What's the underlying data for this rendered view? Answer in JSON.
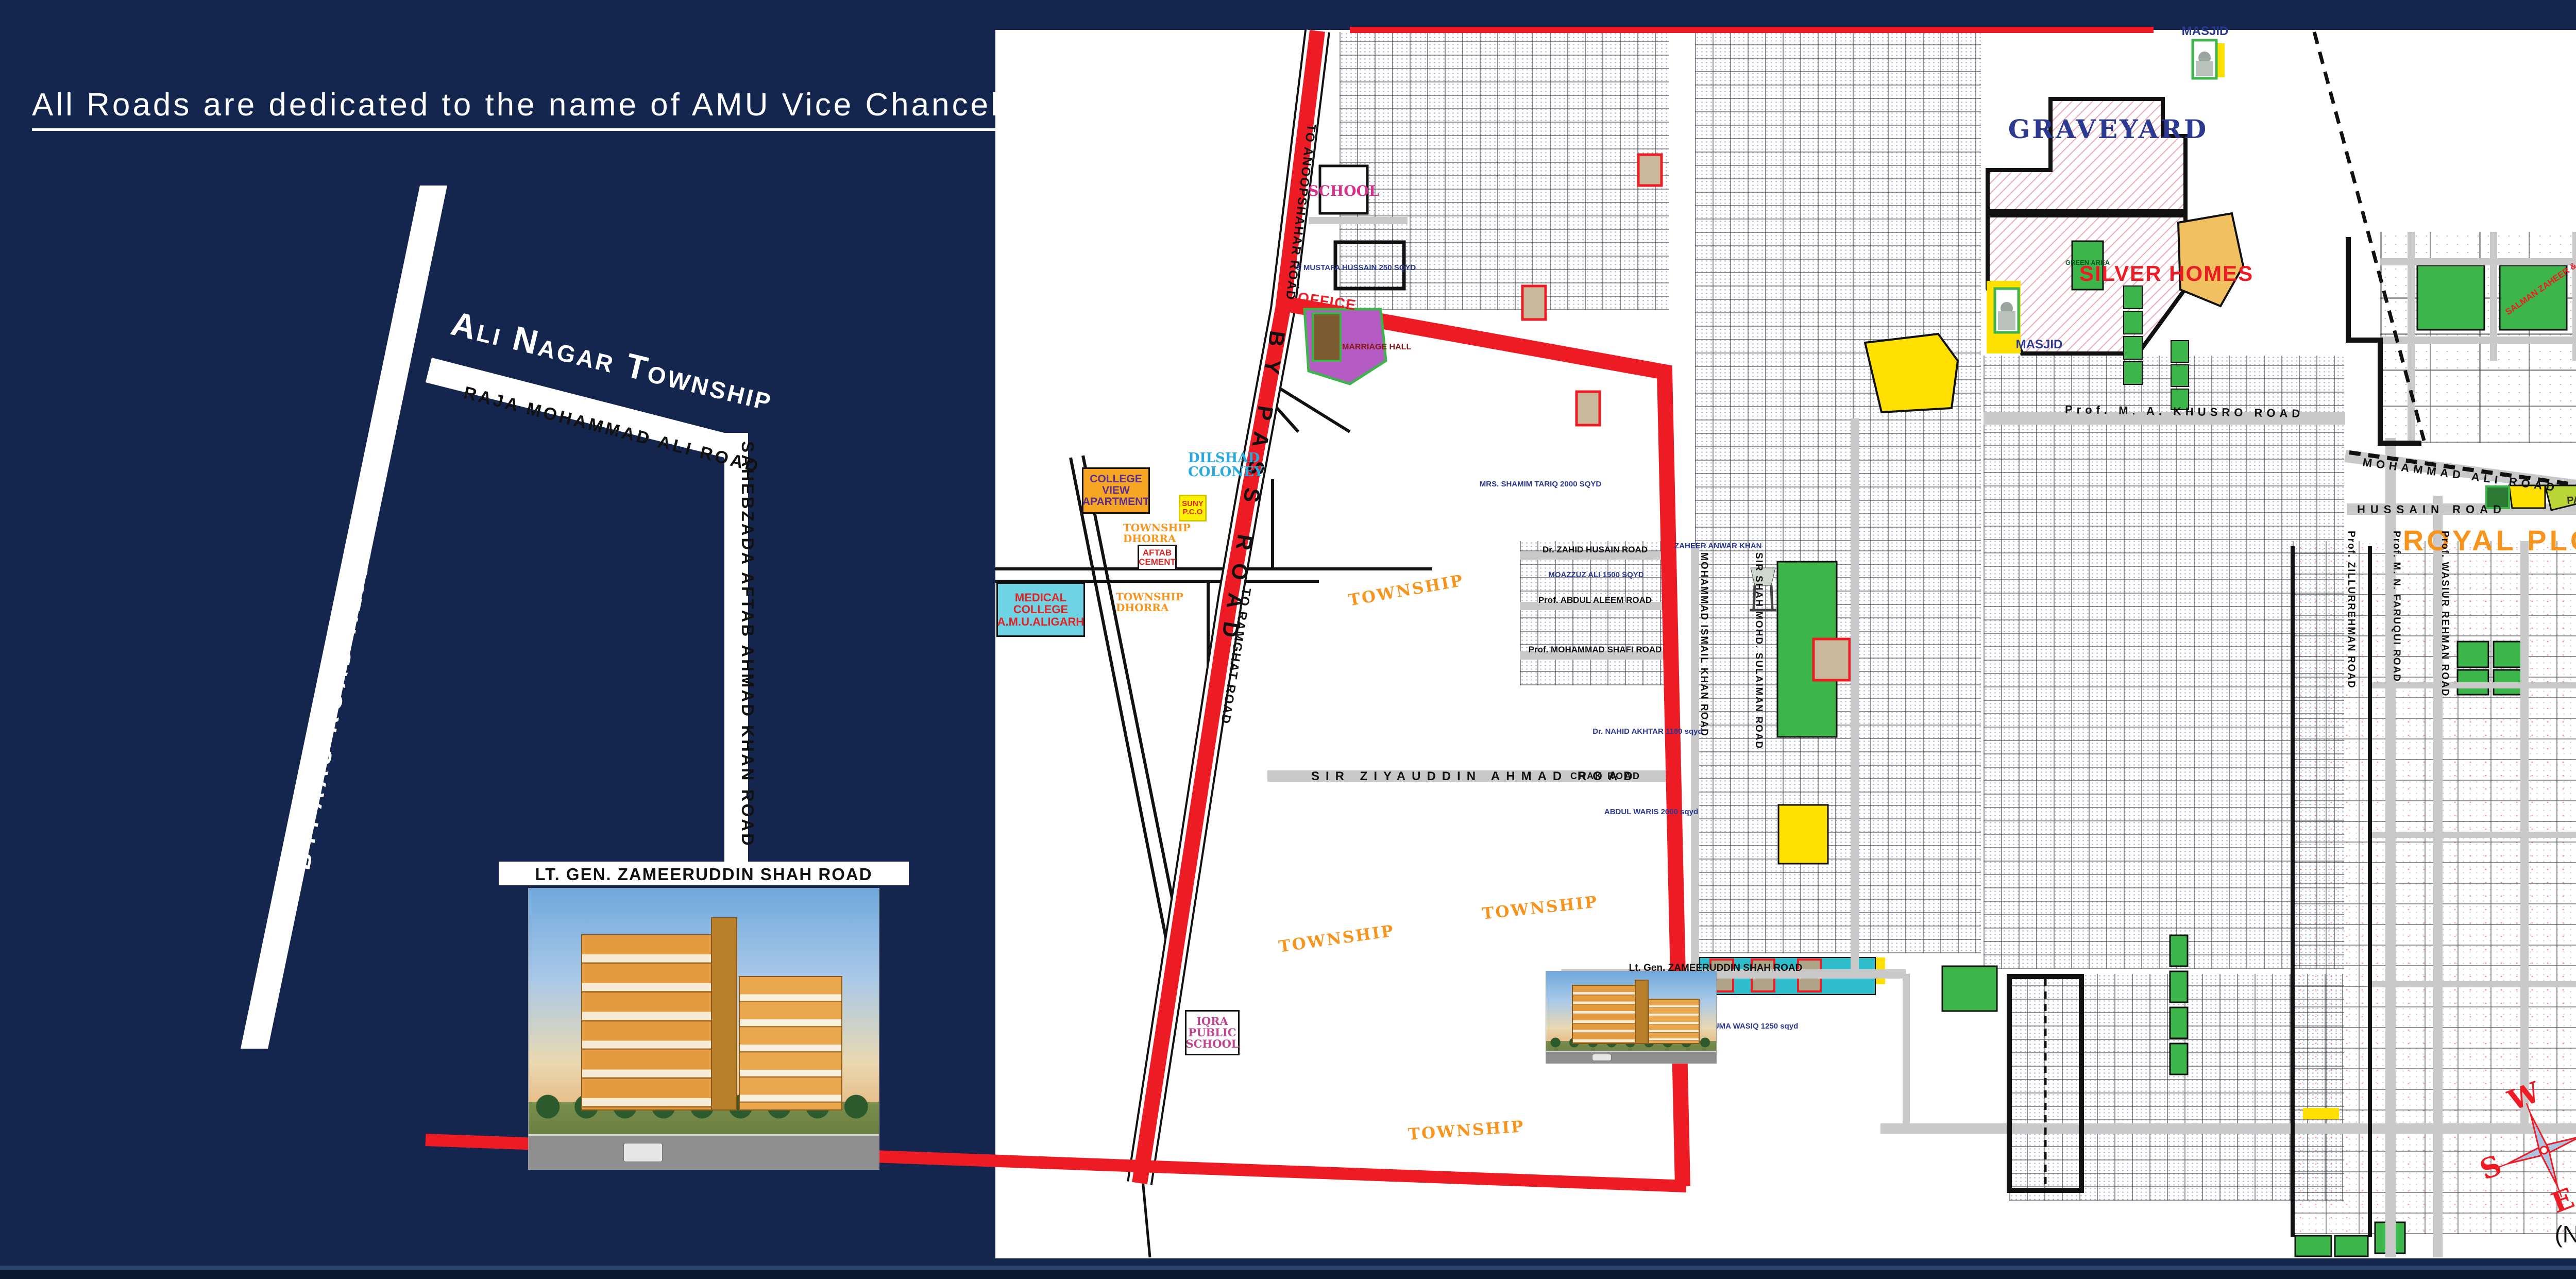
{
  "page": {
    "proposed": "Proposed"
  },
  "left_panel": {
    "heading": "All Roads are dedicated to the name of AMU Vice Chancellors",
    "roads": {
      "bypass": "BYPAAS ROAD ALIGARH",
      "township": "Ali Nagar Township",
      "raja": "RAJA MOHAMMAD ALI ROAD",
      "sahebzada": "SAHEBZADA AFTAB AHMAD KHAN ROAD",
      "lt_gen": "LT. GEN. ZAMEERUDDIN SHAH ROAD"
    }
  },
  "map": {
    "areas": {
      "graveyard": "GRAVEYARD",
      "masjid": "MASJID",
      "green_area": "GREEN AREA",
      "silver_homes": "SILVER HOMES",
      "royal_ploting": "ROYAL PLOTING",
      "park": "PARK",
      "marriage_hall": "MARRIAGE HALL",
      "school": "SCHOOL",
      "office": "OFFICE",
      "dilshad_coloney": "DILSHAD COLONEY",
      "college_view": "COLLEGE VIEW APARTMENT",
      "medical_college": "MEDICAL COLLEGE A.M.U.ALIGARH",
      "suny_pco": "SUNY P.C.O",
      "aftab_cement": "AFTAB CEMENT",
      "township_dhorra": "TOWNSHIP DHORRA",
      "iqra_school": "IQRA PUBLIC SCHOOL",
      "township": "TOWNSHIP"
    },
    "roads": {
      "anoopshahar": "TO ANOOPSHAHAR ROAD",
      "bypass": "BY PASS ROAD",
      "ramghat": "TO RAMGHAT ROAD",
      "khusro": "Prof. M. A. KHUSRO ROAD",
      "mohammad_ali": "MOHAMMAD ALI ROAD",
      "hussain": "HUSSAIN ROAD",
      "zahid": "Dr. ZAHID HUSAIN ROAD",
      "aleem": "Prof. ABDUL ALEEM ROAD",
      "shafi": "Prof. MOHAMMAD SHAFI ROAD",
      "ziyauddin": "SIR ZIYAUDDIN AHMAD ROAD",
      "chak": "CHAK ROAD",
      "zameeruddin": "Lt. Gen. ZAMEERUDDIN SHAH ROAD",
      "faruqui": "Prof. M. N. FARUQUI ROAD",
      "wasiur": "Prof. WASIUR REHMAN ROAD",
      "zillur": "Prof. ZILLURREHMAN ROAD",
      "ismail": "MOHAMMAD ISMAIL KHAN ROAD",
      "sulaiman": "SIR SHAH MOHD. SULAIMAN ROAD"
    },
    "plots": {
      "shamim": "MRS. SHAMIM TARIQ 2000 SQYD",
      "zaheer": "ZAHEER ANWAR KHAN",
      "moazzuz": "MOAZZUZ ALI 1500 SQYD",
      "abdul_waris": "ABDUL WARIS 2000 sqyd",
      "nahid": "Dr. NAHID AKHTAR 1180 sqyd",
      "huma": "HUMA WASIQ 1250 sqyd",
      "mustafa": "S MUSTAFA HUSSAIN 250 SQYD",
      "salman": "SALMAN ZAHEER & SABA ZAHEER"
    },
    "compass": {
      "n": "N",
      "s": "S",
      "e": "E",
      "w": "W"
    },
    "nts": "(N.T.S)"
  },
  "right_panel": {
    "title": "Ali Nagar Township",
    "subtitle": "(Aligarh)",
    "features": [
      "Biggest Muslim Township in India",
      "3 Gated Township",
      "430 Acres Total area of  Township",
      "10 Proposed Mosque",
      "1 Eid-Gah",
      "2 Graveyards",
      "3 Schools",
      "5 Beautiful Parks",
      "1 Overhead Water Tank",
      "2 Hospitals",
      "3 Shopping Centers",
      "1 Electricity Power Station",
      "Wide Roads (60 ft., 40 ft., 30 ft. & 25 ft.)",
      "Easy Connectivity to All Highways"
    ]
  }
}
